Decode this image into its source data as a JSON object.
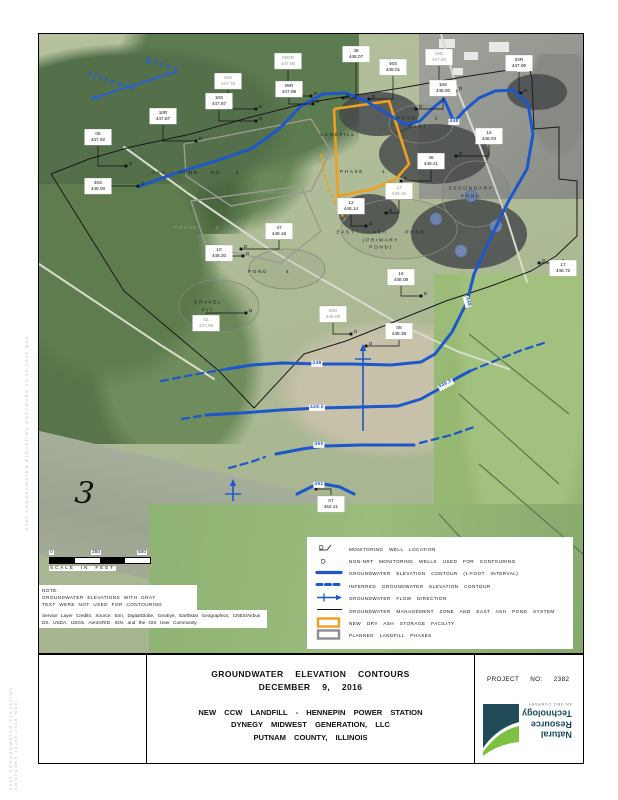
{
  "title_block": {
    "title_line1": "GROUNDWATER ELEVATION CONTOURS",
    "title_line2": "DECEMBER 9, 2016",
    "subtitle_line1": "NEW CCW LANDFILL - HENNEPIN POWER STATION",
    "subtitle_line2": "DYNEGY MIDWEST GENERATION, LLC",
    "subtitle_line3": "PUTNAM COUNTY, ILLINOIS",
    "project_label": "PROJECT NO: 2382"
  },
  "logo": {
    "lines": [
      "Natural",
      "Resource",
      "Technology"
    ],
    "tagline": "AN OBG COMPANY"
  },
  "colors": {
    "contour_blue": "#1c57cc",
    "river_blue": "#2a5fd0",
    "orange": "#f0a01e",
    "boundary_black": "#1a1a1a",
    "phase_gray": "#9b9b93",
    "pond_gray": "#85897c",
    "gray_text": "#979d90"
  },
  "scale_bar": {
    "ticks": [
      "0",
      "250",
      "500"
    ],
    "caption": "SCALE IN FEET"
  },
  "notes": {
    "note_lines": [
      "NOTE:",
      "GROUNDWATER ELEVATIONS WITH GRAY",
      "TEXT WERE NOT USED FOR CONTOURING"
    ],
    "credits": "Service Layer Credits: Source: Esri, DigitalGlobe, GeoEye, Earthstar Geographics, CNES/Airbus DS, USDA, USGS, AeroGRID, IGN, and the GIS User Community"
  },
  "margin_stamp": "2382 GROUNDWATER ELEVATION CONTOURS 12-09-2016 MXD",
  "river": {
    "word1": "Illinois",
    "word2": "River"
  },
  "river_mile_marker": "3",
  "legend": {
    "items": [
      {
        "symbol": "well-nrt",
        "label": "MONITORING WELL LOCATION"
      },
      {
        "symbol": "well-other",
        "label": "NON-NRT MONITORING WELLS USED FOR CONTOURING"
      },
      {
        "symbol": "contour-solid",
        "label": "GROUNDWATER ELEVATION CONTOUR (1-FOOT INTERVAL)"
      },
      {
        "symbol": "contour-inferred",
        "label": "INFERRED GROUNDWATER ELEVATION CONTOUR"
      },
      {
        "symbol": "flow-arrow",
        "label": "GROUNDWATER FLOW DIRECTION"
      },
      {
        "symbol": "gmz-line",
        "label": "GROUNDWATER MANAGEMENT ZONE AND EAST ASH POND SYSTEM"
      },
      {
        "symbol": "orange-rect",
        "label": "NEW DRY ASH STORAGE FACILITY"
      },
      {
        "symbol": "gray-rect",
        "label": "PLANNED LANDFILL PHASES"
      }
    ]
  },
  "map": {
    "area_labels": [
      {
        "lines": [
          "ASH  POND  NO.  2"
        ],
        "x": 157,
        "y": 140,
        "gray": false
      },
      {
        "lines": [
          "LANDFILL"
        ],
        "x": 299,
        "y": 102,
        "gray": false
      },
      {
        "lines": [
          "PHASE   1"
        ],
        "x": 324,
        "y": 139,
        "gray": false
      },
      {
        "lines": [
          "POND   2",
          "EAST"
        ],
        "x": 379,
        "y": 89,
        "gray": false
      },
      {
        "lines": [
          "SECONDARY",
          "POND"
        ],
        "x": 432,
        "y": 159,
        "gray": false
      },
      {
        "lines": [
          "EAST   ASH   POND",
          "(PRIMARY",
          "POND)"
        ],
        "x": 342,
        "y": 207,
        "gray": false
      },
      {
        "lines": [
          "POND   4"
        ],
        "x": 230,
        "y": 239,
        "gray": false
      },
      {
        "lines": [
          "GRAVEL",
          "PIT"
        ],
        "x": 169,
        "y": 273,
        "gray": false
      },
      {
        "lines": [
          "PHASE   2"
        ],
        "x": 247,
        "y": 160,
        "gray": true
      },
      {
        "lines": [
          "PHASE   3"
        ],
        "x": 158,
        "y": 195,
        "gray": true
      }
    ],
    "wells": [
      {
        "id": "06",
        "elev": "447.92",
        "bx": 59,
        "by": 103,
        "wx": 87,
        "wy": 132,
        "gray": false
      },
      {
        "id": "45S",
        "elev": "448.00",
        "bx": 59,
        "by": 152,
        "wx": 99,
        "wy": 152,
        "gray": false
      },
      {
        "id": "10R",
        "elev": "447.87",
        "bx": 124,
        "by": 82,
        "wx": 157,
        "wy": 107,
        "gray": false
      },
      {
        "id": "10S",
        "elev": "447.87",
        "bx": 180,
        "by": 67,
        "wx": 217,
        "wy": 87,
        "gray": false
      },
      {
        "id": "16D",
        "elev": "447.76",
        "bx": 189,
        "by": 47,
        "wx": 217,
        "wy": 75,
        "gray": true
      },
      {
        "id": "05DR",
        "elev": "447.95",
        "bx": 249,
        "by": 27,
        "wx": 272,
        "wy": 62,
        "gray": true
      },
      {
        "id": "05R",
        "elev": "447.99",
        "bx": 250,
        "by": 55,
        "wx": 274,
        "wy": 70,
        "gray": false
      },
      {
        "id": "48",
        "elev": "448.07",
        "bx": 317,
        "by": 20,
        "wx": 304,
        "wy": 64,
        "gray": false
      },
      {
        "id": "46S",
        "elev": "448.01",
        "bx": 354,
        "by": 33,
        "wx": 330,
        "wy": 65,
        "gray": false
      },
      {
        "id": "19D",
        "elev": "447.93",
        "bx": 400,
        "by": 23,
        "wx": 417,
        "wy": 57,
        "gray": true
      },
      {
        "id": "04R",
        "elev": "447.90",
        "bx": 480,
        "by": 29,
        "wx": 482,
        "wy": 59,
        "gray": false
      },
      {
        "id": "18S",
        "elev": "448.00",
        "bx": 404,
        "by": 54,
        "wx": 377,
        "wy": 75,
        "gray": false
      },
      {
        "id": "15",
        "elev": "448.03",
        "bx": 450,
        "by": 102,
        "wx": 417,
        "wy": 122,
        "gray": false
      },
      {
        "id": "46",
        "elev": "448.21",
        "bx": 392,
        "by": 127,
        "wx": 362,
        "wy": 147,
        "gray": false
      },
      {
        "id": "13",
        "elev": "448.16",
        "bx": 360,
        "by": 157,
        "wx": 347,
        "wy": 179,
        "gray": true
      },
      {
        "id": "12",
        "elev": "448.14",
        "bx": 312,
        "by": 172,
        "wx": 327,
        "wy": 192,
        "gray": false
      },
      {
        "id": "47",
        "elev": "448.18",
        "bx": 240,
        "by": 197,
        "wx": 202,
        "wy": 215,
        "gray": false
      },
      {
        "id": "10",
        "elev": "448.20",
        "bx": 180,
        "by": 219,
        "wx": 204,
        "wy": 222,
        "gray": false
      },
      {
        "id": "02",
        "elev": "447.99",
        "bx": 167,
        "by": 289,
        "wx": 207,
        "wy": 279,
        "gray": true
      },
      {
        "id": "16",
        "elev": "448.08",
        "bx": 362,
        "by": 243,
        "wx": 382,
        "wy": 262,
        "gray": false
      },
      {
        "id": "08D",
        "elev": "448.09",
        "bx": 294,
        "by": 280,
        "wx": 312,
        "wy": 300,
        "gray": true
      },
      {
        "id": "08",
        "elev": "448.39",
        "bx": 360,
        "by": 297,
        "wx": 327,
        "wy": 312,
        "gray": false
      },
      {
        "id": "07",
        "elev": "452.21",
        "bx": 292,
        "by": 470,
        "wx": 277,
        "wy": 455,
        "gray": false
      },
      {
        "id": "17",
        "elev": "448.72",
        "bx": 524,
        "by": 234,
        "wx": 500,
        "wy": 229,
        "gray": false
      }
    ],
    "contours": [
      {
        "dashed": false,
        "width": 3,
        "points": [
          [
            99,
            153
          ],
          [
            137,
            139
          ],
          [
            177,
            127
          ],
          [
            212,
            115
          ],
          [
            240,
            95
          ],
          [
            262,
            72
          ],
          [
            284,
            60
          ],
          [
            307,
            59
          ],
          [
            327,
            67
          ],
          [
            347,
            79
          ],
          [
            367,
            91
          ],
          [
            381,
            87
          ],
          [
            394,
            74
          ],
          [
            405,
            65
          ],
          [
            415,
            88
          ],
          [
            426,
            76
          ],
          [
            440,
            64
          ],
          [
            456,
            57
          ],
          [
            474,
            56
          ],
          [
            489,
            70
          ],
          [
            494,
            100
          ],
          [
            488,
            135
          ],
          [
            469,
            168
          ],
          [
            451,
            205
          ],
          [
            435,
            240
          ],
          [
            428,
            268
          ],
          [
            413,
            298
          ],
          [
            396,
            320
          ],
          [
            382,
            328
          ],
          [
            352,
            331
          ],
          [
            312,
            330
          ],
          [
            280,
            330
          ],
          [
            243,
            329
          ],
          [
            213,
            331
          ],
          [
            188,
            335
          ]
        ],
        "labels": [
          {
            "t": "448",
            "x": 415,
            "y": 88,
            "r": 0
          },
          {
            "t": "448",
            "x": 428,
            "y": 268,
            "r": 75
          },
          {
            "t": "448",
            "x": 278,
            "y": 330,
            "r": 0
          }
        ]
      },
      {
        "dashed": true,
        "width": 2.2,
        "points": [
          [
            188,
            335
          ],
          [
            158,
            340
          ],
          [
            122,
            347
          ]
        ],
        "labels": []
      },
      {
        "dashed": false,
        "width": 3,
        "points": [
          [
            167,
            381
          ],
          [
            202,
            379
          ],
          [
            242,
            376
          ],
          [
            280,
            374
          ],
          [
            322,
            373
          ],
          [
            359,
            372
          ],
          [
            382,
            365
          ],
          [
            400,
            355
          ],
          [
            418,
            344
          ],
          [
            431,
            337
          ]
        ],
        "labels": [
          {
            "t": "449.0",
            "x": 278,
            "y": 374,
            "r": 0
          },
          {
            "t": "449.0",
            "x": 407,
            "y": 351,
            "r": -28
          }
        ]
      },
      {
        "dashed": true,
        "width": 2.2,
        "points": [
          [
            143,
            385
          ],
          [
            167,
            381
          ]
        ],
        "labels": []
      },
      {
        "dashed": true,
        "width": 2.2,
        "points": [
          [
            431,
            337
          ],
          [
            458,
            326
          ],
          [
            483,
            316
          ],
          [
            508,
            308
          ]
        ],
        "labels": []
      },
      {
        "dashed": false,
        "width": 3,
        "points": [
          [
            237,
            420
          ],
          [
            263,
            415
          ],
          [
            286,
            412
          ],
          [
            322,
            411
          ],
          [
            358,
            411
          ],
          [
            375,
            411
          ]
        ],
        "labels": [
          {
            "t": "450",
            "x": 280,
            "y": 411,
            "r": 0
          }
        ]
      },
      {
        "dashed": true,
        "width": 2.2,
        "points": [
          [
            190,
            434
          ],
          [
            212,
            428
          ],
          [
            226,
            423
          ]
        ],
        "labels": []
      },
      {
        "dashed": true,
        "width": 2.2,
        "points": [
          [
            381,
            409
          ],
          [
            412,
            401
          ],
          [
            438,
            392
          ]
        ],
        "labels": []
      },
      {
        "dashed": false,
        "width": 3,
        "points": [
          [
            258,
            460
          ],
          [
            272,
            453
          ],
          [
            285,
            450
          ],
          [
            301,
            453
          ],
          [
            315,
            460
          ]
        ],
        "labels": [
          {
            "t": "451",
            "x": 280,
            "y": 451,
            "r": 0
          }
        ]
      }
    ],
    "boundary": [
      [
        12,
        140
      ],
      [
        50,
        125
      ],
      [
        92,
        113
      ],
      [
        152,
        100
      ],
      [
        212,
        83
      ],
      [
        272,
        68
      ],
      [
        317,
        61
      ],
      [
        362,
        54
      ],
      [
        424,
        43
      ],
      [
        490,
        33
      ],
      [
        493,
        45
      ],
      [
        495,
        95
      ],
      [
        520,
        93
      ],
      [
        520,
        145
      ],
      [
        538,
        147
      ],
      [
        538,
        202
      ],
      [
        517,
        222
      ],
      [
        492,
        237
      ],
      [
        452,
        252
      ],
      [
        407,
        267
      ],
      [
        357,
        287
      ],
      [
        307,
        307
      ],
      [
        265,
        320
      ],
      [
        215,
        374
      ],
      [
        180,
        337
      ],
      [
        85,
        257
      ],
      [
        12,
        140
      ]
    ],
    "orange_solid": [
      [
        295,
        75
      ],
      [
        350,
        67
      ],
      [
        370,
        130
      ],
      [
        357,
        145
      ],
      [
        334,
        155
      ],
      [
        299,
        162
      ],
      [
        295,
        75
      ]
    ],
    "orange_dashed": [
      [
        282,
        120
      ],
      [
        287,
        147
      ],
      [
        296,
        168
      ],
      [
        306,
        186
      ]
    ],
    "phase_polys": [
      [
        [
          145,
          110
        ],
        [
          272,
          85
        ],
        [
          292,
          117
        ],
        [
          272,
          157
        ],
        [
          192,
          172
        ],
        [
          147,
          142
        ],
        [
          145,
          110
        ]
      ],
      [
        [
          152,
          167
        ],
        [
          262,
          152
        ],
        [
          282,
          197
        ],
        [
          242,
          229
        ],
        [
          167,
          212
        ],
        [
          152,
          167
        ]
      ]
    ],
    "ponds": [
      {
        "cx": 382,
        "cy": 90,
        "rx": 32,
        "ry": 19
      },
      {
        "cx": 437,
        "cy": 160,
        "rx": 34,
        "ry": 33
      },
      {
        "cx": 360,
        "cy": 195,
        "rx": 58,
        "ry": 30
      },
      {
        "cx": 248,
        "cy": 235,
        "rx": 38,
        "ry": 20
      },
      {
        "cx": 180,
        "cy": 272,
        "rx": 40,
        "ry": 26
      }
    ],
    "roads": [
      [
        [
          85,
          113
        ],
        [
          150,
          160
        ],
        [
          230,
          215
        ],
        [
          300,
          255
        ],
        [
          360,
          290
        ],
        [
          420,
          318
        ],
        [
          470,
          335
        ]
      ],
      [
        [
          402,
          0
        ],
        [
          418,
          55
        ],
        [
          442,
          115
        ],
        [
          468,
          185
        ],
        [
          488,
          248
        ]
      ],
      [
        [
          0,
          230
        ],
        [
          60,
          270
        ],
        [
          120,
          310
        ],
        [
          175,
          345
        ]
      ]
    ],
    "channels": [
      [
        [
          430,
          300
        ],
        [
          530,
          380
        ]
      ],
      [
        [
          420,
          360
        ],
        [
          520,
          450
        ]
      ],
      [
        [
          440,
          430
        ],
        [
          544,
          520
        ]
      ],
      [
        [
          400,
          480
        ],
        [
          500,
          590
        ]
      ]
    ],
    "flow_arrows": [
      {
        "x": 324,
        "y1": 397,
        "y2": 312
      },
      {
        "x": 194,
        "y1": 467,
        "y2": 447
      }
    ],
    "river_arrow": {
      "x1": 139,
      "y1": 37,
      "x2": 52,
      "y2": 65
    },
    "tanks": [
      {
        "x": 432,
        "y": 162
      },
      {
        "x": 457,
        "y": 192
      },
      {
        "x": 422,
        "y": 217
      },
      {
        "x": 397,
        "y": 185
      }
    ],
    "roofs": [
      [
        400,
        5,
        16,
        9
      ],
      [
        425,
        18,
        14,
        8
      ],
      [
        450,
        8,
        20,
        10
      ],
      [
        478,
        30,
        12,
        8
      ],
      [
        414,
        34,
        10,
        7
      ]
    ],
    "coal": [
      {
        "cx": 340,
        "cy": 80,
        "rx": 40,
        "ry": 22
      },
      {
        "cx": 395,
        "cy": 120,
        "rx": 55,
        "ry": 30
      },
      {
        "cx": 430,
        "cy": 200,
        "rx": 58,
        "ry": 35
      },
      {
        "cx": 330,
        "cy": 180,
        "rx": 30,
        "ry": 20
      },
      {
        "cx": 498,
        "cy": 58,
        "rx": 30,
        "ry": 18
      }
    ]
  }
}
